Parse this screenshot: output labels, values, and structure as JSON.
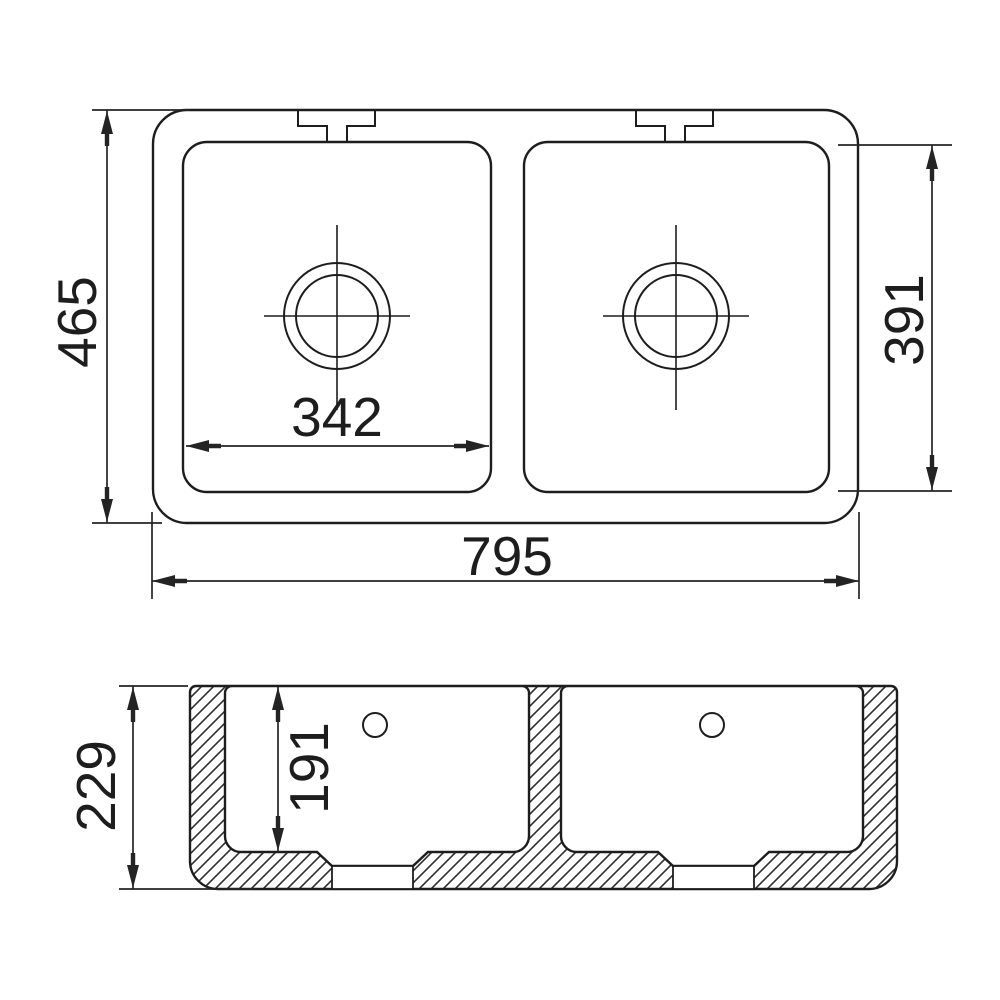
{
  "colors": {
    "line": "#1d1d1d",
    "dimension_line": "#242424",
    "background": "#ffffff"
  },
  "plan_view": {
    "overall_width": "795",
    "overall_depth": "465",
    "bowl_width": "342",
    "bowl_depth": "391"
  },
  "section_view": {
    "overall_height": "229",
    "bowl_inner_depth": "191"
  }
}
